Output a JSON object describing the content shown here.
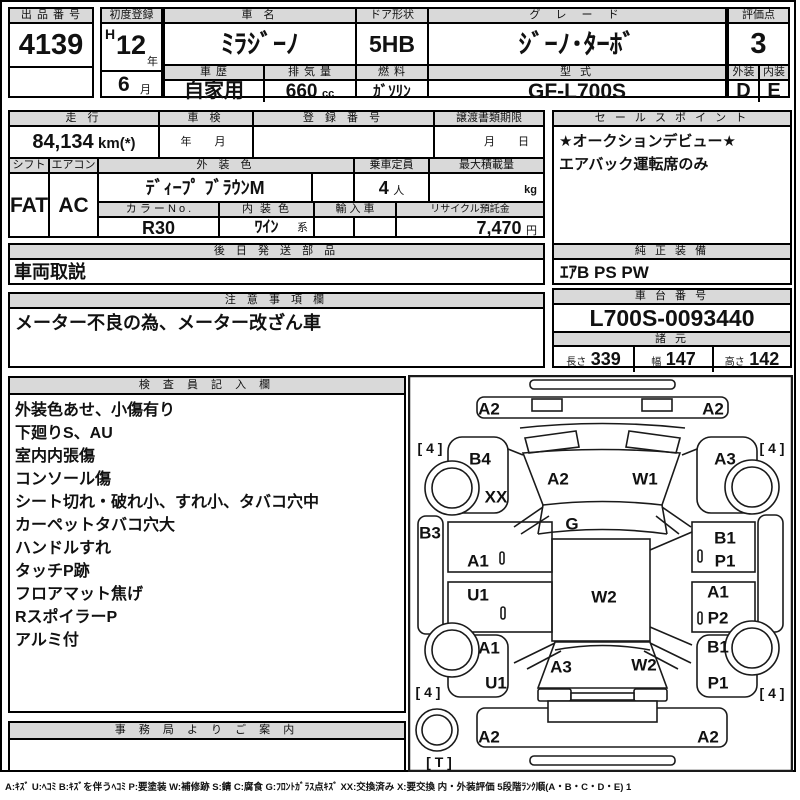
{
  "top": {
    "auction_no": {
      "label": "出 品 番 号",
      "value": "4139"
    },
    "first_reg": {
      "label": "初度登録",
      "era": "H",
      "year": "12",
      "year_suffix": "年",
      "month": "6",
      "month_suffix": "月"
    },
    "car_name": {
      "label": "車  名",
      "value": "ﾐﾗｼﾞｰﾉ"
    },
    "history": {
      "label": "車 歴",
      "value": "自家用"
    },
    "displacement": {
      "label": "排 気 量",
      "value": "660",
      "unit": "cc"
    },
    "door": {
      "label": "ドア形状",
      "value": "5HB"
    },
    "fuel": {
      "label": "燃 料",
      "value": "ｶﾞｿﾘﾝ"
    },
    "grade": {
      "label": "グ レ ー ド",
      "value": "ｼﾞｰﾉ･ﾀｰﾎﾞ"
    },
    "model": {
      "label": "型 式",
      "value": "GF-L700S"
    },
    "score": {
      "label": "評価点",
      "value": "3"
    },
    "exterior": {
      "label": "外装",
      "value": "D"
    },
    "interior": {
      "label": "内装",
      "value": "E"
    }
  },
  "middle": {
    "mileage": {
      "label": "走 行",
      "value": "84,134",
      "unit": "km(*)"
    },
    "shaken": {
      "label": "車 検",
      "value": "年　月"
    },
    "reg_no": {
      "label": "登 録 番 号",
      "value": ""
    },
    "transfer": {
      "label": "譲渡書類期限",
      "value": "月　日"
    },
    "shift": {
      "label": "シフト",
      "value": "FAT"
    },
    "aircon": {
      "label": "エアコン",
      "value": "AC"
    },
    "ext_color": {
      "label": "外 装 色",
      "value": "ﾃﾞｨｰﾌﾟ ﾌﾞﾗｳﾝM"
    },
    "capacity": {
      "label": "乗車定員",
      "value": "4",
      "unit": "人"
    },
    "max_load": {
      "label": "最大積載量",
      "value": "",
      "unit": "kg"
    },
    "color_no": {
      "label": "カ ラ ー N o .",
      "value": "R30"
    },
    "int_color": {
      "label": "内 装 色",
      "value": "ﾜｲﾝ",
      "suffix": "系"
    },
    "import_car": {
      "label": "輸 入 車",
      "value": ""
    },
    "recycle": {
      "label": "リサイクル預託金",
      "value": "7,470",
      "unit": "円"
    },
    "sales_point": {
      "label": "セ ー ル ス ポ イ ン ト",
      "lines": [
        "★オークションデビュー★",
        "エアバック運転席のみ"
      ]
    },
    "later_parts": {
      "label": "後 日 発 送 部 品",
      "value": "車両取説"
    },
    "genuine_equip": {
      "label": "純 正 装 備",
      "value": "ｴｱB PS PW"
    },
    "caution": {
      "label": "注 意 事 項 欄",
      "value": "メーター不良の為、メーター改ざん車"
    },
    "chassis": {
      "label": "車 台 番 号",
      "value": "L700S-0093440"
    },
    "specs": {
      "label": "諸 元",
      "length_label": "長さ",
      "length": "339",
      "width_label": "幅",
      "width": "147",
      "height_label": "高さ",
      "height": "142"
    }
  },
  "inspector": {
    "label": "検 査 員 記 入 欄",
    "lines": [
      "外装色あせ、小傷有り",
      "下廻りS、AU",
      "室内内張傷",
      "コンソール傷",
      "シート切れ・破れ小、すれ小、タバコ穴中",
      "カーペットタバコ穴大",
      "ハンドルすれ",
      "タッチP跡",
      "フロアマット焦げ",
      "RスポイラーP",
      "アルミ付"
    ]
  },
  "office": {
    "label": "事 務 局 よ り ご 案 内",
    "value": ""
  },
  "legend": "A:ｷｽﾞ U:ﾍｺﾐ B:ｷｽﾞを伴うﾍｺﾐ P:要塗装 W:補修跡 S:錆 C:腐食 G:ﾌﾛﾝﾄｶﾞﾗｽ点ｷｽﾞ XX:交換済み X:要交換 内・外装評価 5段階ﾗﾝｸ順(A・B・C・D・E) 1",
  "diagram": {
    "markers": [
      {
        "label": "A2",
        "x": 81,
        "y": 34
      },
      {
        "label": "A2",
        "x": 305,
        "y": 34
      },
      {
        "label": "[ 4 ]",
        "x": 22,
        "y": 73,
        "small": true
      },
      {
        "label": "B4",
        "x": 72,
        "y": 84
      },
      {
        "label": "A3",
        "x": 317,
        "y": 84
      },
      {
        "label": "[ 4 ]",
        "x": 364,
        "y": 73,
        "small": true
      },
      {
        "label": "XX",
        "x": 88,
        "y": 122
      },
      {
        "label": "A2",
        "x": 150,
        "y": 104
      },
      {
        "label": "W1",
        "x": 237,
        "y": 104
      },
      {
        "label": "G",
        "x": 164,
        "y": 149
      },
      {
        "label": "B3",
        "x": 22,
        "y": 158
      },
      {
        "label": "A1",
        "x": 70,
        "y": 186
      },
      {
        "label": "U1",
        "x": 70,
        "y": 220
      },
      {
        "label": "W2",
        "x": 196,
        "y": 222
      },
      {
        "label": "B1",
        "x": 317,
        "y": 163
      },
      {
        "label": "P1",
        "x": 317,
        "y": 186
      },
      {
        "label": "A1",
        "x": 310,
        "y": 217
      },
      {
        "label": "P2",
        "x": 310,
        "y": 243
      },
      {
        "label": "A1",
        "x": 81,
        "y": 273
      },
      {
        "label": "U1",
        "x": 88,
        "y": 308
      },
      {
        "label": "A3",
        "x": 153,
        "y": 292
      },
      {
        "label": "W2",
        "x": 236,
        "y": 290
      },
      {
        "label": "B1",
        "x": 310,
        "y": 272
      },
      {
        "label": "P1",
        "x": 310,
        "y": 308
      },
      {
        "label": "[ 4 ]",
        "x": 20,
        "y": 317,
        "small": true
      },
      {
        "label": "[ 4 ]",
        "x": 364,
        "y": 318,
        "small": true
      },
      {
        "label": "A2",
        "x": 81,
        "y": 362
      },
      {
        "label": "A2",
        "x": 300,
        "y": 362
      },
      {
        "label": "[ T ]",
        "x": 31,
        "y": 387,
        "small": true
      }
    ]
  }
}
